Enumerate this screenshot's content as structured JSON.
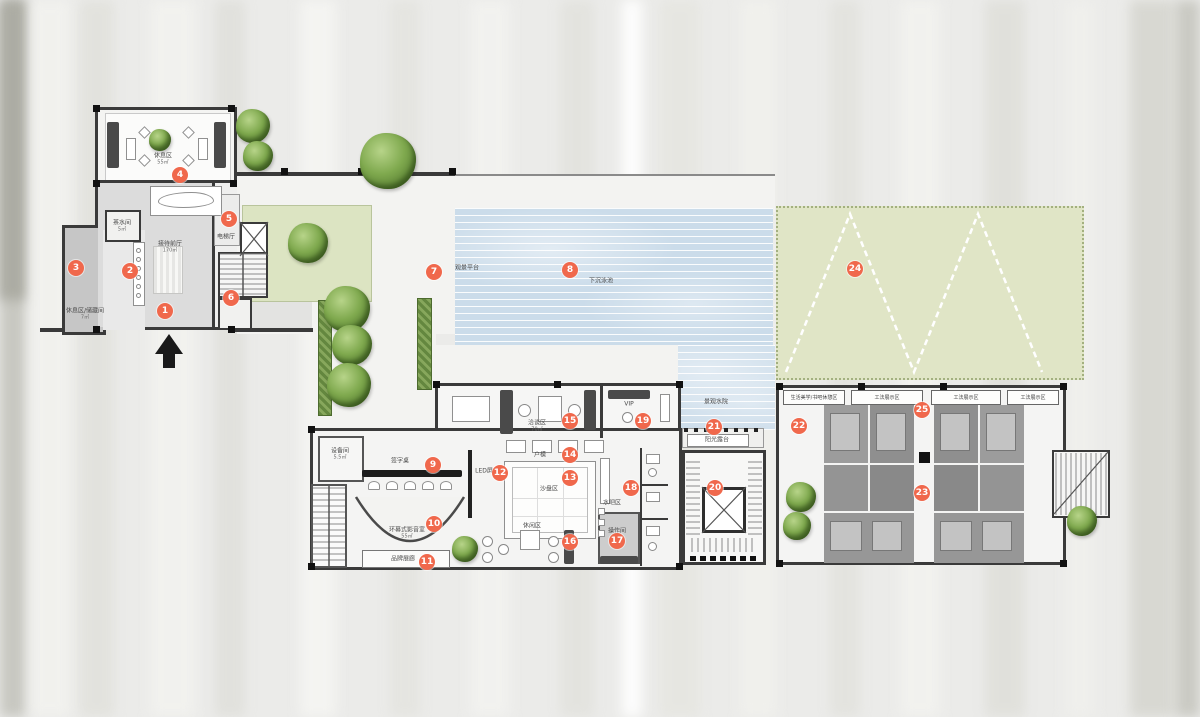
{
  "colors": {
    "marker": "#f0684c",
    "wall": "#3a3a3a",
    "pool_water": "#cbdcea",
    "lawn": "#e0e5c6",
    "tree": "#7fa94e",
    "floor_gray": "#dcdcdc",
    "unit_dark": "#8e8e8e"
  },
  "markers": [
    {
      "n": "1",
      "x": 165,
      "y": 311
    },
    {
      "n": "2",
      "x": 130,
      "y": 271
    },
    {
      "n": "3",
      "x": 76,
      "y": 268
    },
    {
      "n": "4",
      "x": 180,
      "y": 175
    },
    {
      "n": "5",
      "x": 229,
      "y": 219
    },
    {
      "n": "6",
      "x": 231,
      "y": 298
    },
    {
      "n": "7",
      "x": 434,
      "y": 272
    },
    {
      "n": "8",
      "x": 570,
      "y": 270
    },
    {
      "n": "9",
      "x": 433,
      "y": 465
    },
    {
      "n": "10",
      "x": 434,
      "y": 524
    },
    {
      "n": "11",
      "x": 427,
      "y": 562
    },
    {
      "n": "12",
      "x": 500,
      "y": 473
    },
    {
      "n": "13",
      "x": 570,
      "y": 478
    },
    {
      "n": "14",
      "x": 570,
      "y": 455
    },
    {
      "n": "15",
      "x": 570,
      "y": 421
    },
    {
      "n": "16",
      "x": 570,
      "y": 542
    },
    {
      "n": "17",
      "x": 617,
      "y": 541
    },
    {
      "n": "18",
      "x": 631,
      "y": 488
    },
    {
      "n": "19",
      "x": 643,
      "y": 421
    },
    {
      "n": "20",
      "x": 715,
      "y": 488
    },
    {
      "n": "21",
      "x": 714,
      "y": 427
    },
    {
      "n": "22",
      "x": 799,
      "y": 426
    },
    {
      "n": "23",
      "x": 922,
      "y": 493
    },
    {
      "n": "24",
      "x": 855,
      "y": 269
    },
    {
      "n": "25",
      "x": 922,
      "y": 410
    }
  ],
  "labels": [
    {
      "text": "休息区",
      "sub": "55㎡",
      "x": 163,
      "y": 159
    },
    {
      "text": "茶水间",
      "sub": "5㎡",
      "x": 122,
      "y": 226
    },
    {
      "text": "接待前厅",
      "sub": "170㎡",
      "x": 170,
      "y": 247
    },
    {
      "text": "休息区/储藏间",
      "sub": "7㎡",
      "x": 85,
      "y": 314
    },
    {
      "text": "电梯厅",
      "x": 226,
      "y": 237
    },
    {
      "text": "观景平台",
      "x": 467,
      "y": 268
    },
    {
      "text": "下沉泳池",
      "x": 601,
      "y": 281
    },
    {
      "text": "景观水院",
      "x": 716,
      "y": 402
    },
    {
      "text": "阳光露台",
      "x": 717,
      "y": 440
    },
    {
      "text": "洽谈区",
      "sub": "70㎡",
      "x": 537,
      "y": 426
    },
    {
      "text": "VIP",
      "x": 629,
      "y": 404
    },
    {
      "text": "户模",
      "x": 540,
      "y": 455
    },
    {
      "text": "沙盘区",
      "x": 549,
      "y": 489
    },
    {
      "text": "LED屏",
      "x": 484,
      "y": 471
    },
    {
      "text": "水吧区",
      "x": 612,
      "y": 503
    },
    {
      "text": "操作间",
      "x": 617,
      "y": 531
    },
    {
      "text": "签字桌",
      "x": 400,
      "y": 461
    },
    {
      "text": "环幕式影音室",
      "sub": "55㎡",
      "x": 407,
      "y": 533
    },
    {
      "text": "品牌展廊",
      "x": 403,
      "y": 559
    },
    {
      "text": "设备间",
      "sub": "5.5㎡",
      "x": 340,
      "y": 454
    },
    {
      "text": "休闲区",
      "x": 532,
      "y": 526
    }
  ],
  "display_boxes": [
    {
      "text": "生活美学/书吧休憩区",
      "x": 783,
      "y": 390,
      "w": 62,
      "h": 15
    },
    {
      "text": "工法展示区",
      "x": 851,
      "y": 390,
      "w": 72,
      "h": 15
    },
    {
      "text": "工法展示区",
      "x": 931,
      "y": 390,
      "w": 70,
      "h": 15
    },
    {
      "text": "工法展示区",
      "x": 1007,
      "y": 390,
      "w": 52,
      "h": 15
    }
  ],
  "trees": [
    {
      "x": 253,
      "y": 126,
      "d": 34
    },
    {
      "x": 258,
      "y": 156,
      "d": 30
    },
    {
      "x": 388,
      "y": 161,
      "d": 56
    },
    {
      "x": 308,
      "y": 243,
      "d": 40
    },
    {
      "x": 347,
      "y": 309,
      "d": 46
    },
    {
      "x": 352,
      "y": 345,
      "d": 40
    },
    {
      "x": 349,
      "y": 385,
      "d": 44
    },
    {
      "x": 160,
      "y": 140,
      "d": 22
    },
    {
      "x": 465,
      "y": 549,
      "d": 26
    },
    {
      "x": 801,
      "y": 497,
      "d": 30
    },
    {
      "x": 797,
      "y": 526,
      "d": 28
    },
    {
      "x": 1082,
      "y": 521,
      "d": 30
    }
  ]
}
